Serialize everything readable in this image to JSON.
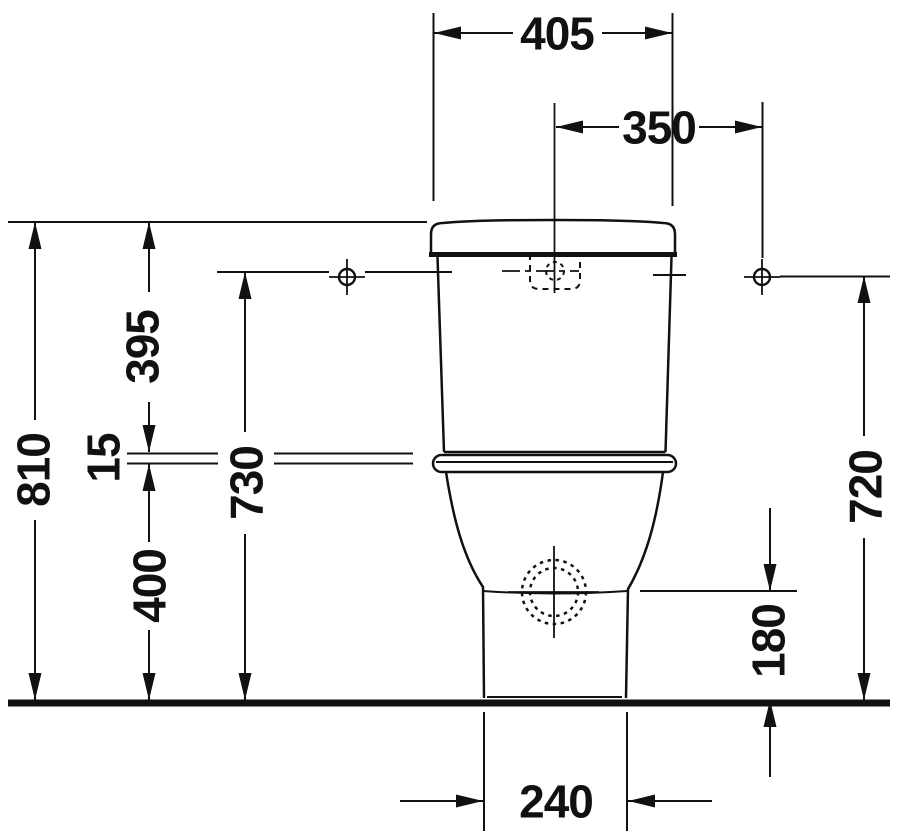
{
  "drawing": {
    "dimensions": {
      "overall_width": "405",
      "fixing_hole_spacing": "350",
      "tank_top_to_joint": "395",
      "joint_gap": "15",
      "joint_to_floor": "400",
      "overall_height": "810",
      "fixing_line_to_floor": "730",
      "fixing_hole_height": "720",
      "outlet_height": "180",
      "pedestal_width": "240"
    },
    "colors": {
      "line": "#111111",
      "background": "#ffffff"
    }
  }
}
